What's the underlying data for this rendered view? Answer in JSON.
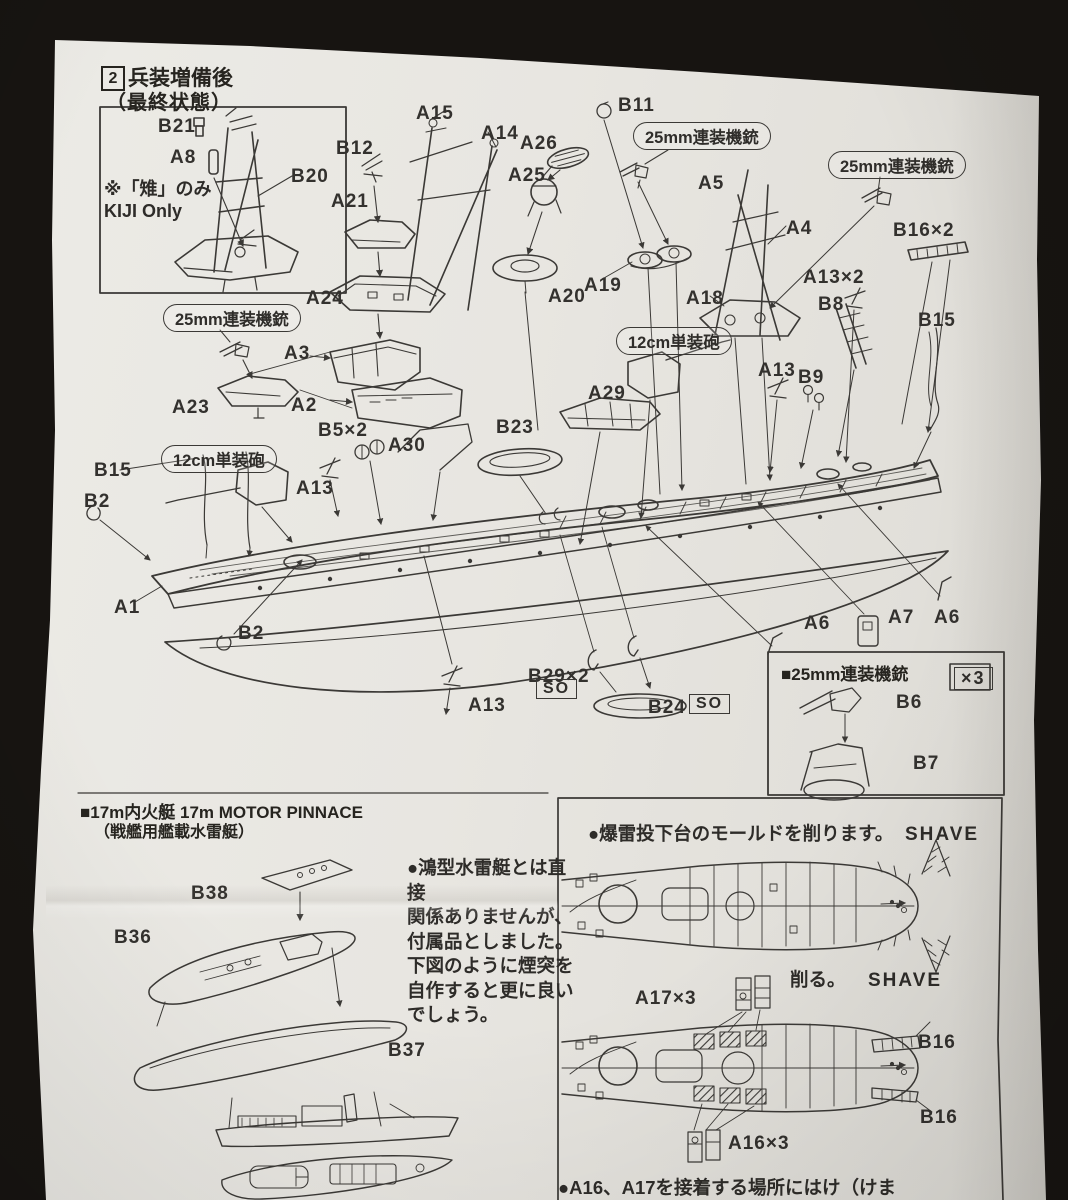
{
  "meta": {
    "background_color": "#171411",
    "paper_color": "#e8e6e1",
    "ink_color": "#3b3936",
    "document_type": "model kit assembly instructions (photographed paper sheet)"
  },
  "header": {
    "step_number": "2",
    "title": "兵装増備後",
    "subtitle": "（最終状態）"
  },
  "inset": {
    "note": "※「雉」のみ\nKIJI Only"
  },
  "callouts": [
    {
      "t": "25mm連装機銃",
      "x": 633,
      "y": 122
    },
    {
      "t": "25mm連装機銃",
      "x": 828,
      "y": 151
    },
    {
      "t": "25mm連装機銃",
      "x": 163,
      "y": 304
    },
    {
      "t": "12cm単装砲",
      "x": 616,
      "y": 327
    },
    {
      "t": "12cm単装砲",
      "x": 161,
      "y": 445
    }
  ],
  "parts": [
    {
      "t": "B21",
      "x": 158,
      "y": 116
    },
    {
      "t": "A8",
      "x": 170,
      "y": 147
    },
    {
      "t": "B20",
      "x": 291,
      "y": 166
    },
    {
      "t": "B12",
      "x": 336,
      "y": 138
    },
    {
      "t": "A15",
      "x": 416,
      "y": 103
    },
    {
      "t": "A14",
      "x": 481,
      "y": 123
    },
    {
      "t": "A26",
      "x": 520,
      "y": 133
    },
    {
      "t": "A25",
      "x": 508,
      "y": 165
    },
    {
      "t": "B11",
      "x": 618,
      "y": 95
    },
    {
      "t": "A21",
      "x": 331,
      "y": 191
    },
    {
      "t": "A5",
      "x": 698,
      "y": 173
    },
    {
      "t": "A4",
      "x": 786,
      "y": 218
    },
    {
      "t": "B16×2",
      "x": 893,
      "y": 220
    },
    {
      "t": "A24",
      "x": 306,
      "y": 288
    },
    {
      "t": "A13×2",
      "x": 803,
      "y": 267
    },
    {
      "t": "B8",
      "x": 818,
      "y": 294
    },
    {
      "t": "A20",
      "x": 548,
      "y": 286
    },
    {
      "t": "A19",
      "x": 584,
      "y": 275
    },
    {
      "t": "A18",
      "x": 686,
      "y": 288
    },
    {
      "t": "B15",
      "x": 918,
      "y": 310
    },
    {
      "t": "A3",
      "x": 284,
      "y": 343
    },
    {
      "t": "A23",
      "x": 172,
      "y": 397
    },
    {
      "t": "A2",
      "x": 291,
      "y": 395
    },
    {
      "t": "B5×2",
      "x": 318,
      "y": 420
    },
    {
      "t": "A30",
      "x": 388,
      "y": 435
    },
    {
      "t": "B23",
      "x": 496,
      "y": 417
    },
    {
      "t": "A29",
      "x": 588,
      "y": 383
    },
    {
      "t": "A13",
      "x": 758,
      "y": 360
    },
    {
      "t": "B9",
      "x": 798,
      "y": 367
    },
    {
      "t": "B15",
      "x": 94,
      "y": 460
    },
    {
      "t": "B2",
      "x": 84,
      "y": 491
    },
    {
      "t": "A13",
      "x": 296,
      "y": 478
    },
    {
      "t": "A1",
      "x": 114,
      "y": 597
    },
    {
      "t": "B2",
      "x": 238,
      "y": 623
    },
    {
      "t": "A6",
      "x": 804,
      "y": 613
    },
    {
      "t": "A7",
      "x": 888,
      "y": 607
    },
    {
      "t": "A6",
      "x": 934,
      "y": 607
    },
    {
      "t": "A13",
      "x": 468,
      "y": 695
    },
    {
      "t": "B29×2",
      "x": 528,
      "y": 666
    },
    {
      "t": "B24",
      "x": 648,
      "y": 697
    },
    {
      "t": "B6",
      "x": 896,
      "y": 692
    },
    {
      "t": "B7",
      "x": 913,
      "y": 753
    },
    {
      "t": "B38",
      "x": 191,
      "y": 883
    },
    {
      "t": "B36",
      "x": 114,
      "y": 927
    },
    {
      "t": "B37",
      "x": 388,
      "y": 1040
    },
    {
      "t": "A17×3",
      "x": 635,
      "y": 988
    },
    {
      "t": "B16",
      "x": 918,
      "y": 1032
    },
    {
      "t": "B16",
      "x": 920,
      "y": 1107
    },
    {
      "t": "A16×3",
      "x": 728,
      "y": 1133
    }
  ],
  "so_text": "SO",
  "so_badges": [
    {
      "x": 536,
      "y": 679
    },
    {
      "x": 689,
      "y": 694
    }
  ],
  "box25": {
    "title": "■25mm連装機銃",
    "multiplier": "×3"
  },
  "pinnace": {
    "title": "■17m内火艇 17m MOTOR PINNACE",
    "subtitle": "（戦艦用艦載水雷艇）",
    "note": "●鴻型水雷艇とは直接\n関係ありませんが、\n付属品としました。\n下図のように煙突を\n自作すると更に良い\nでしょう。"
  },
  "panel": {
    "note": "●爆雷投下台のモールドを削ります。",
    "shave_top": "SHAVE",
    "cut_label": "削る。",
    "shave_bottom": "SHAVE",
    "truncated_note": "●A16、A17を接着する場所にはけ（けま"
  }
}
